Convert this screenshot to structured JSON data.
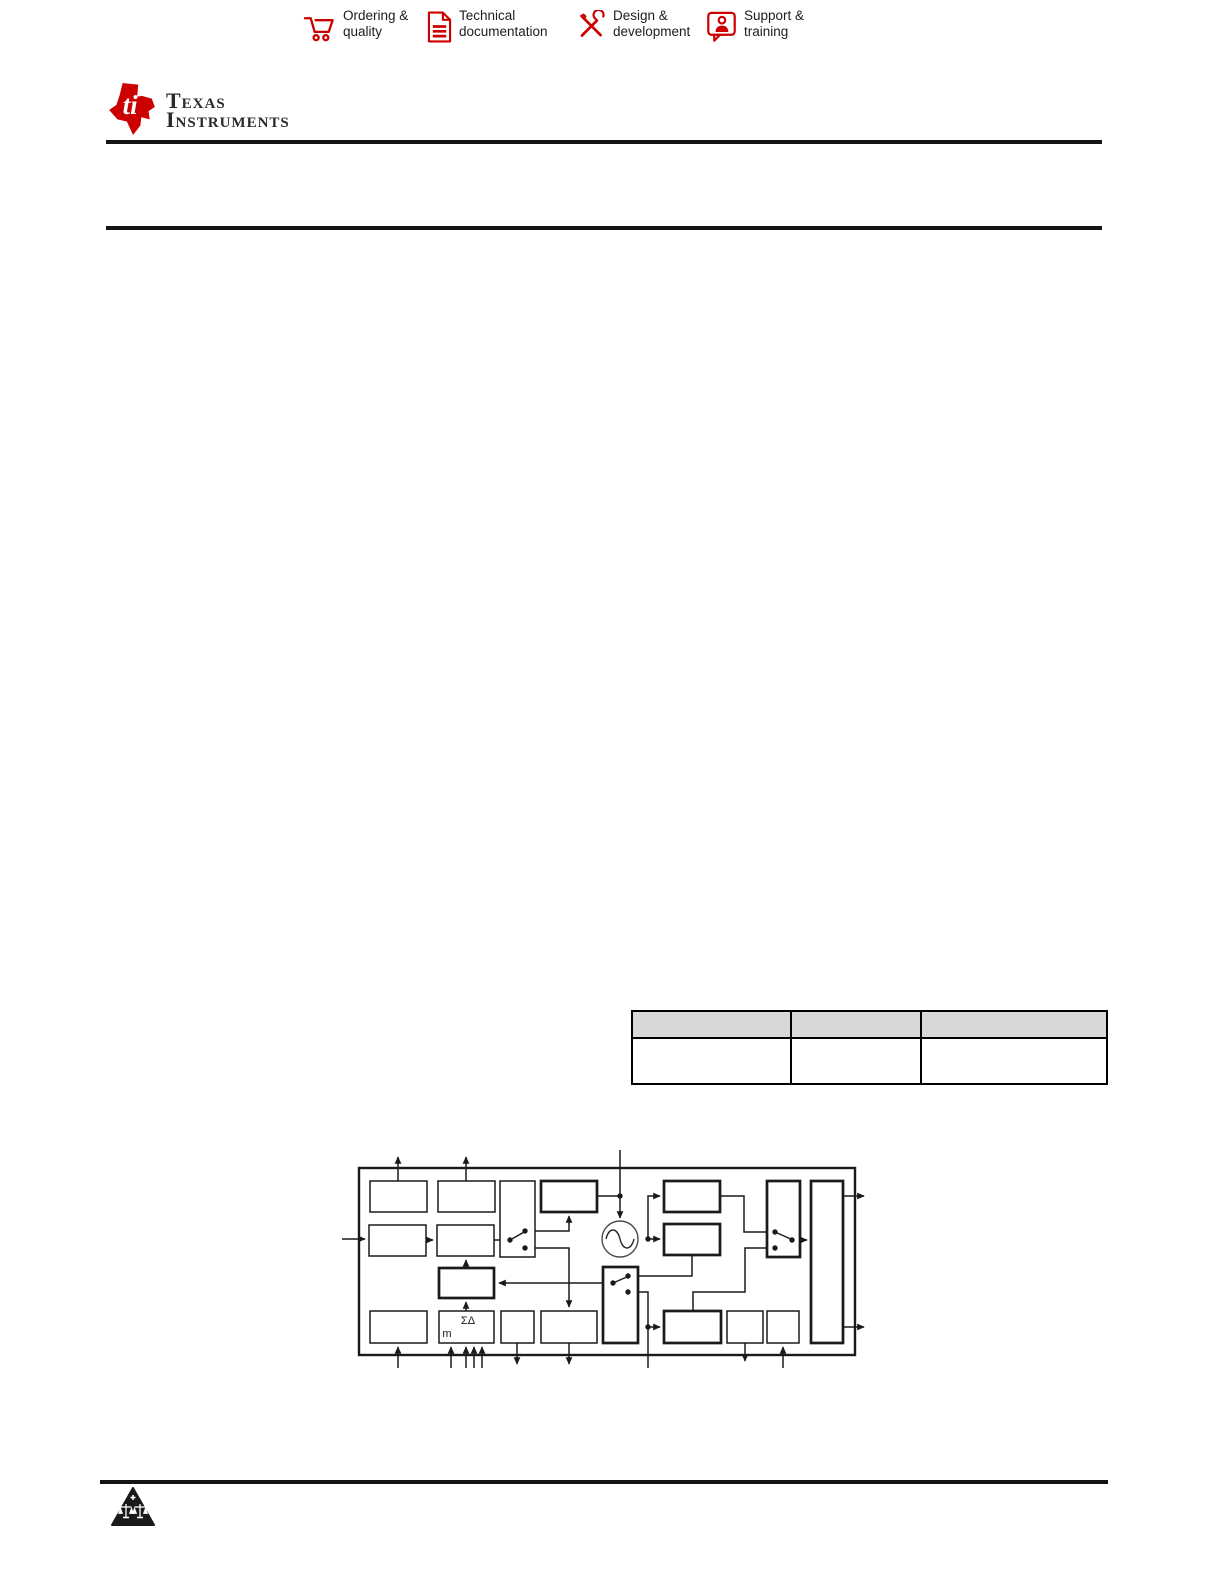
{
  "colors": {
    "accent_red": "#cc0000",
    "text_dark": "#1d1d1d",
    "rule_black": "#131313",
    "table_header_bg": "#d8d8d8",
    "diagram_stroke": "#1a1a1a"
  },
  "header": {
    "nav_items": [
      {
        "icon": "cart-icon",
        "line1": "Ordering &",
        "line2": "quality"
      },
      {
        "icon": "document-icon",
        "line1": "Technical",
        "line2": "documentation"
      },
      {
        "icon": "design-icon",
        "line1": "Design &",
        "line2": "development"
      },
      {
        "icon": "support-icon",
        "line1": "Support &",
        "line2": "training"
      }
    ],
    "brand": {
      "name_line1": "Texas",
      "name_line2": "Instruments"
    }
  },
  "table": {
    "header_cells": [
      "",
      "",
      ""
    ],
    "body_cells": [
      "",
      "",
      ""
    ]
  },
  "diagram": {
    "labels": {
      "sigma_delta": "ΣΔ",
      "m": "m"
    }
  },
  "footer": {
    "mark_icon": "scales-triangle-icon"
  }
}
